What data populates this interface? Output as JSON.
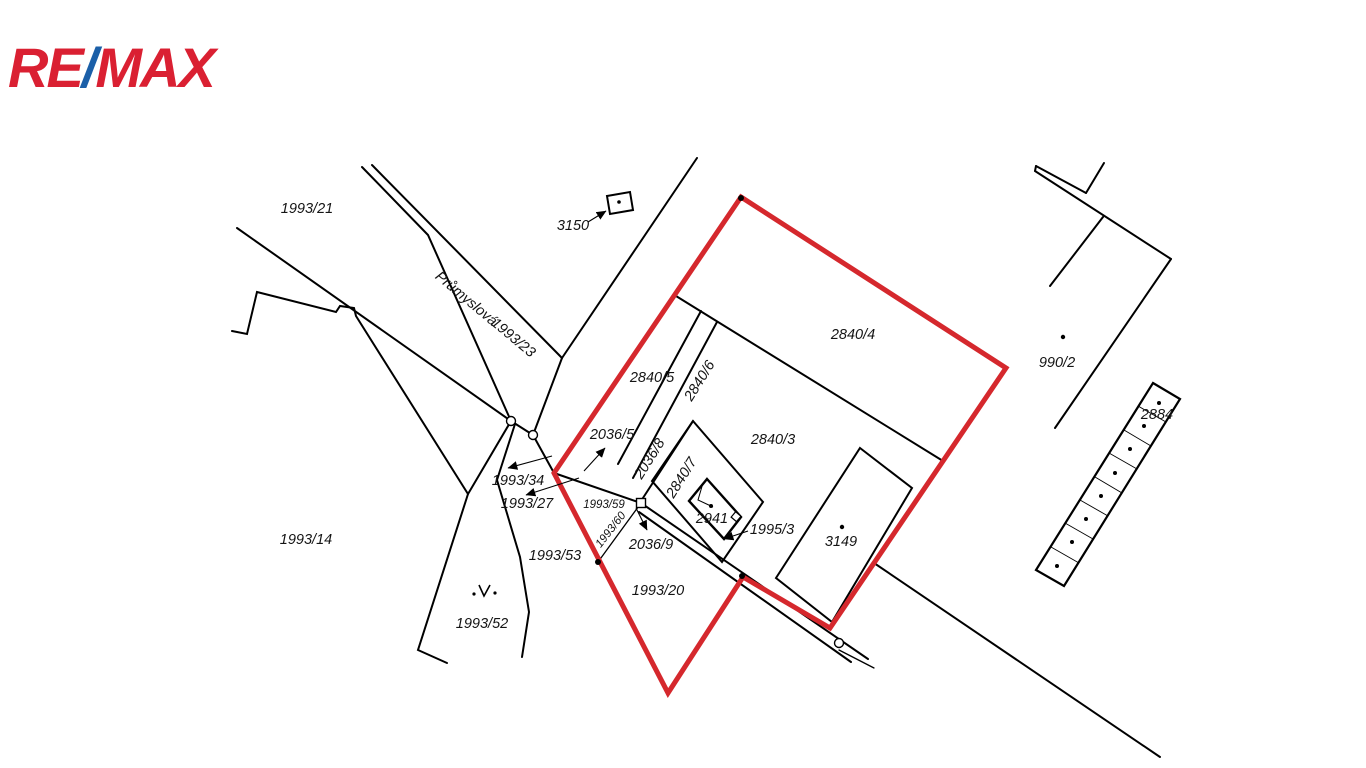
{
  "brand": {
    "part1": "RE",
    "slash": "/",
    "part2": "MAX"
  },
  "colors": {
    "highlight": "#d5282d",
    "logo_red": "#da2032",
    "logo_blue": "#1b5fa8",
    "line": "#000000"
  },
  "map": {
    "street_name": "Průmyslová",
    "highlighted_parcels": [
      "2840/4",
      "2840/3",
      "2840/5",
      "2840/6",
      "2036/8",
      "2840/7",
      "2941",
      "3149",
      "1993/20"
    ],
    "labels": [
      {
        "text": "1993/21"
      },
      {
        "text": "3150"
      },
      {
        "text": "Průmyslová"
      },
      {
        "text": "1993/23"
      },
      {
        "text": "2840/4"
      },
      {
        "text": "990/2"
      },
      {
        "text": "2840/5"
      },
      {
        "text": "2840/6"
      },
      {
        "text": "2884"
      },
      {
        "text": "2036/5"
      },
      {
        "text": "2840/3"
      },
      {
        "text": "2036/8"
      },
      {
        "text": "1993/34"
      },
      {
        "text": "2840/7"
      },
      {
        "text": "1993/27"
      },
      {
        "text": "1993/59"
      },
      {
        "text": "2941"
      },
      {
        "text": "1995/3"
      },
      {
        "text": "1993/60"
      },
      {
        "text": "1993/14"
      },
      {
        "text": "3149"
      },
      {
        "text": "2036/9"
      },
      {
        "text": "1993/53"
      },
      {
        "text": "1993/20"
      },
      {
        "text": "1993/52"
      }
    ]
  }
}
